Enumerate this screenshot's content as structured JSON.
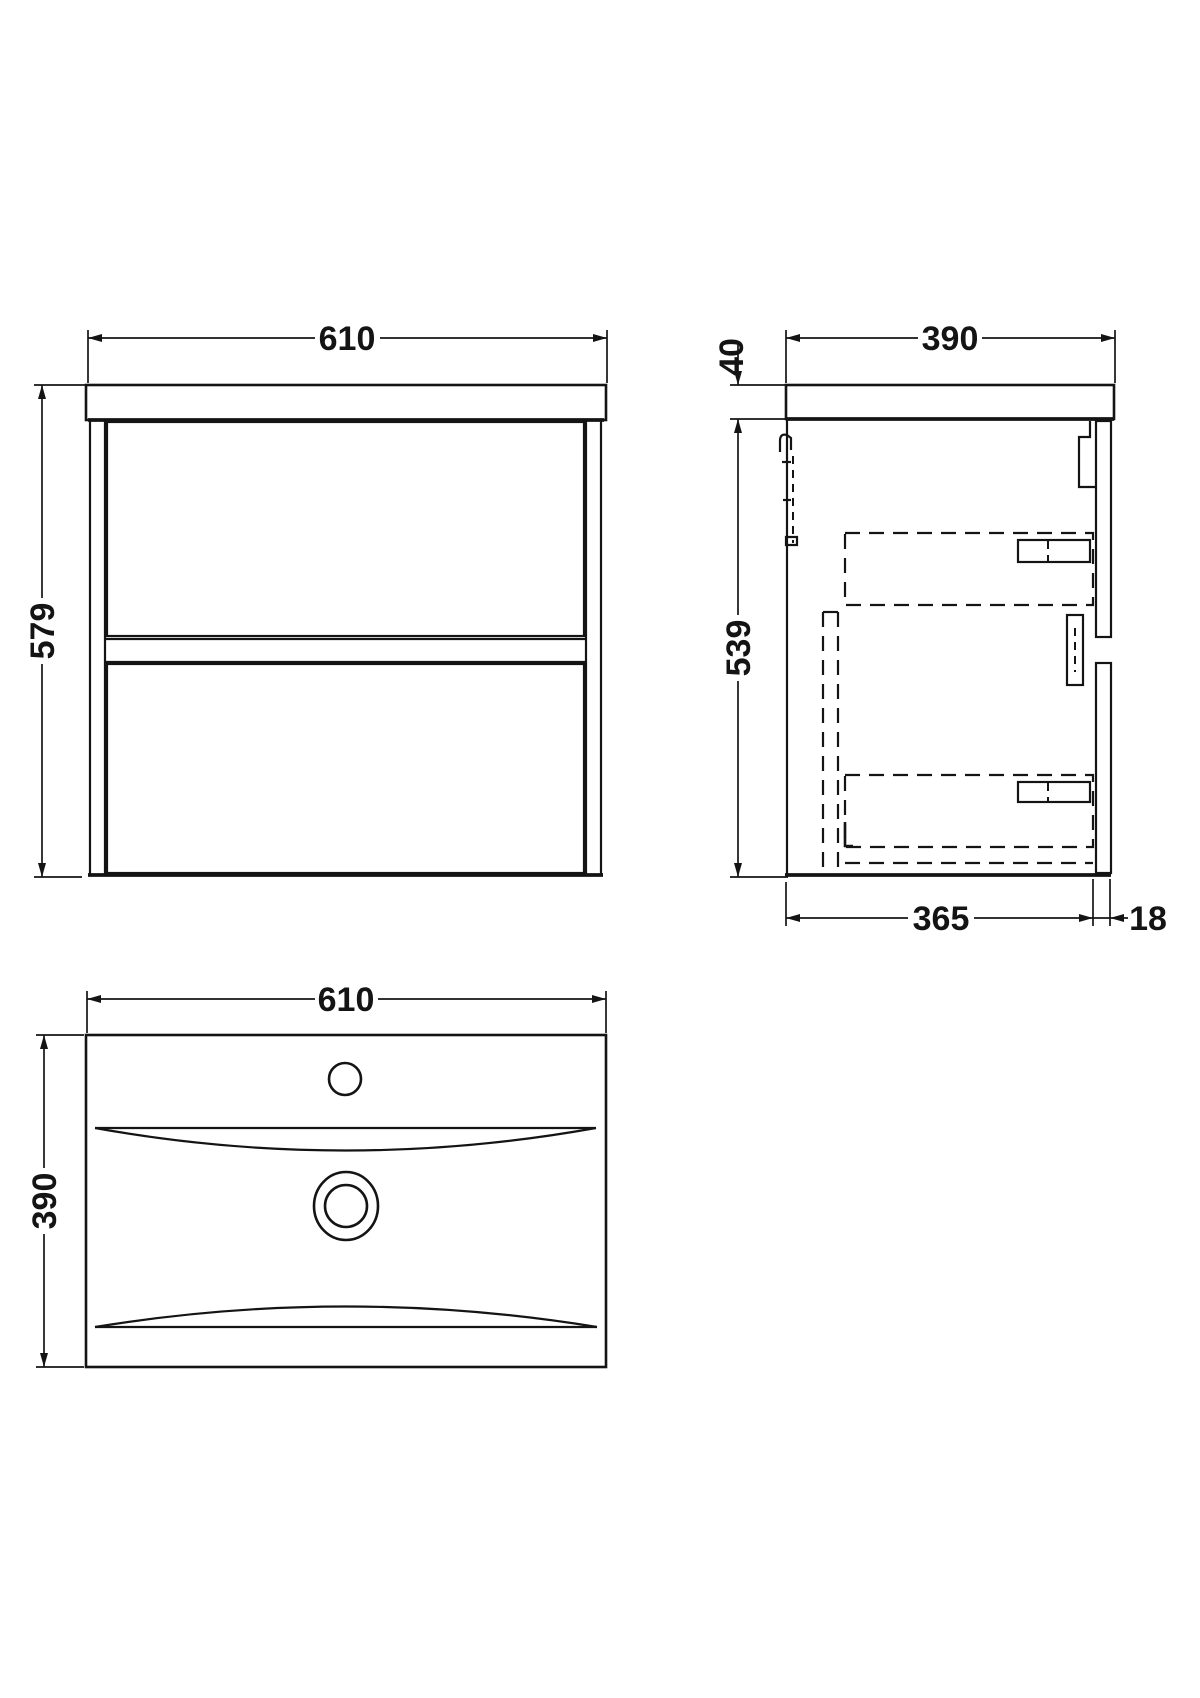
{
  "drawing": {
    "front_view": {
      "width": "610",
      "height": "579"
    },
    "side_view": {
      "depth": "390",
      "worktop_thickness": "40",
      "cabinet_height": "539",
      "internal_depth": "365",
      "front_panel_thickness": "18"
    },
    "plan_view": {
      "width": "610",
      "depth": "390"
    }
  },
  "colors": {
    "line": "#141414",
    "background": "#ffffff"
  }
}
